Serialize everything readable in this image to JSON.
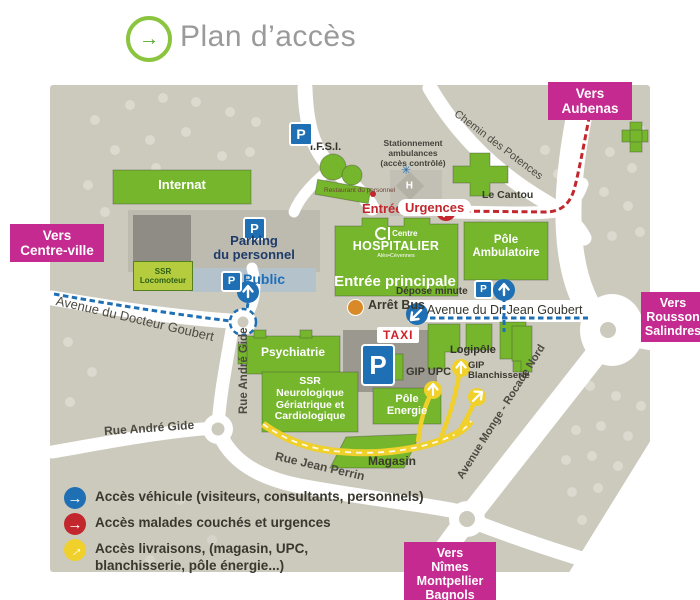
{
  "header": {
    "title": "Plan d’accès"
  },
  "directions": {
    "aubenas": "Vers\nAubenas",
    "centre_ville": "Vers\nCentre-ville",
    "rousson": "Vers\nRousson\nSalindres",
    "nimes": "Vers\nNîmes\nMontpellier\nBagnols"
  },
  "roads": {
    "chemin_potences": "Chemin des Potences",
    "avenue_docteur_goubert": "Avenue du Docteur Goubert",
    "rue_andre_gide_v": "Rue André Gide",
    "rue_andre_gide_h": "Rue André Gide",
    "rue_jean_perrin": "Rue Jean Perrin",
    "avenue_monge": "Avenue Monge - Rocade Nord",
    "avenue_dr_jean_goubert": "Avenue du Dr Jean Goubert"
  },
  "buildings": {
    "internat": "Internat",
    "ifsi": "I.F.S.I.",
    "restaurant": "Restaurant du personnel",
    "le_cantou": "Le Cantou",
    "hopital_centre": "Centre",
    "hopital_name": "HOSPITALIER",
    "hopital_sub": "Alès•Cévennes",
    "entree_principale": "Entrée principale",
    "pole_ambulatoire": "Pôle\nAmbulatoire",
    "psychiatrie": "Psychiatrie",
    "ssr_neurologique": "SSR\nNeurologique\nGériatrique et\nCardiologique",
    "pole_energie": "Pôle\nEnergie",
    "magasin": "Magasin",
    "logipole": "Logipôle",
    "gip_upc": "GIP UPC",
    "gip_blanchisserie": "GIP\nBlanchisserie",
    "ssr_locomoteur": "SSR\nLocomoteur"
  },
  "parking": {
    "p": "P",
    "personnel": "Parking\ndu personnel",
    "public": "Public"
  },
  "signs": {
    "entree": "Entrée",
    "urgences": "Urgences",
    "stationnement": "Stationnement\nambulances\n(accès contrôlé)",
    "h": "H",
    "depose_minute": "Dépose minute",
    "arret_bus": "Arrêt Bus",
    "taxi": "TAXI"
  },
  "legend": {
    "vehicule": "Accès véhicule (visiteurs, consultants, personnels)",
    "malades": "Accès malades couchés et urgences",
    "livraisons": "Accès livraisons, (magasin, UPC,\nblanchisserie, pôle énergie...)"
  },
  "colors": {
    "magenta": "#c52a90",
    "building_green": "#75b62c",
    "route_blue": "#1f6fb4",
    "route_red": "#c1272d",
    "route_yellow": "#f0d02b",
    "map_gray": "#ccc9bd"
  }
}
